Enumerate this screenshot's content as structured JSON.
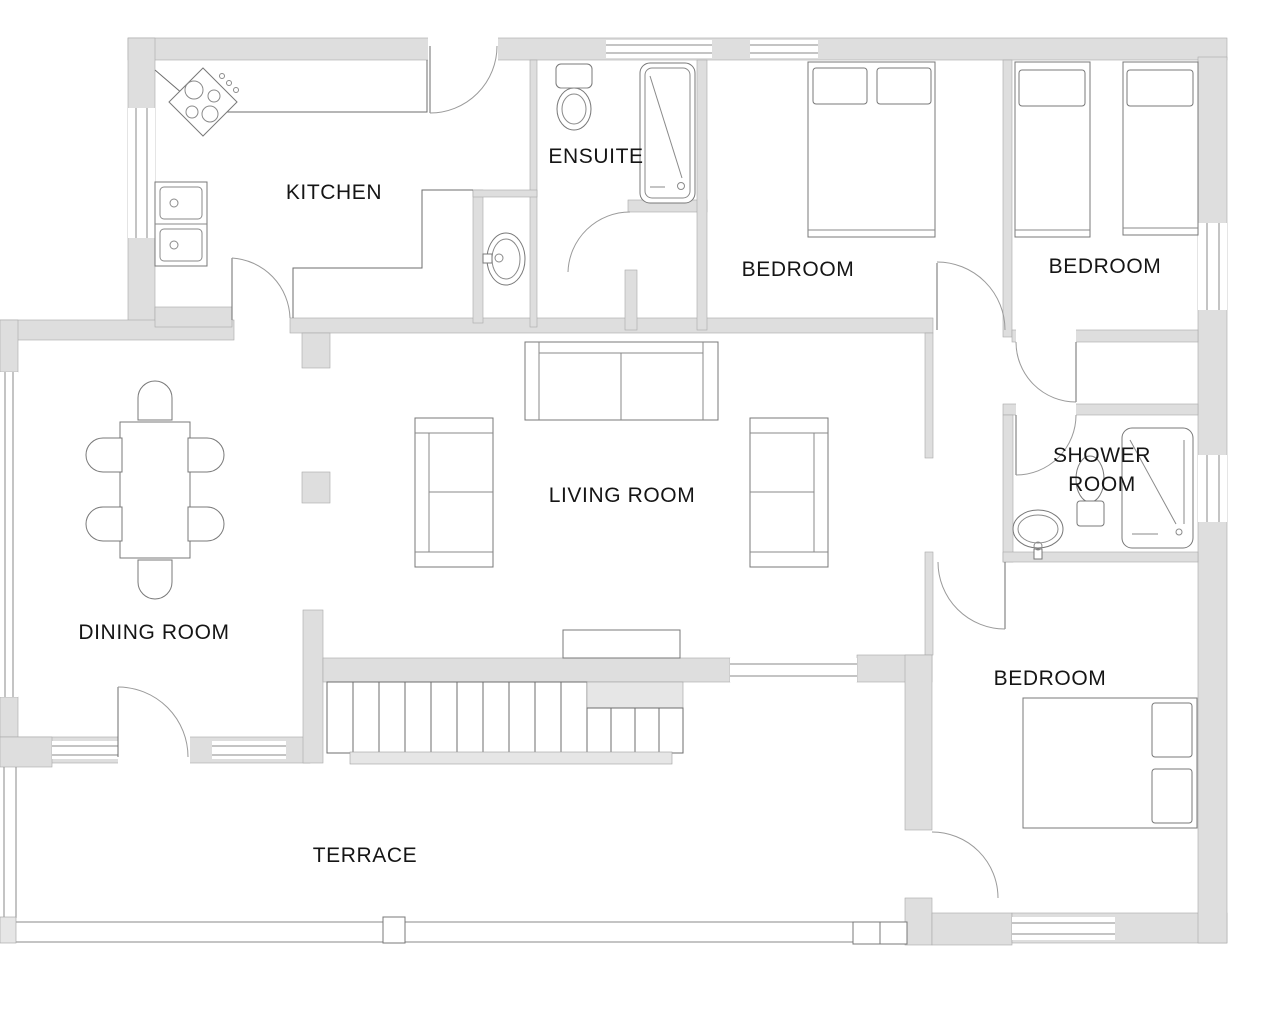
{
  "floor_plan": {
    "rooms": [
      {
        "id": "kitchen",
        "label": "KITCHEN"
      },
      {
        "id": "ensuite",
        "label": "ENSUITE"
      },
      {
        "id": "bedroom-1",
        "label": "BEDROOM"
      },
      {
        "id": "bedroom-2",
        "label": "BEDROOM"
      },
      {
        "id": "shower-room",
        "label": "SHOWER ROOM",
        "lines": [
          "SHOWER",
          "ROOM"
        ]
      },
      {
        "id": "living-room",
        "label": "LIVING ROOM"
      },
      {
        "id": "dining-room",
        "label": "DINING ROOM"
      },
      {
        "id": "bedroom-3",
        "label": "BEDROOM"
      },
      {
        "id": "terrace",
        "label": "TERRACE"
      }
    ],
    "colors": {
      "background": "#ffffff",
      "wall_fill": "#dedede",
      "wall_stroke": "#a8a8a8",
      "line": "#6e6e6e",
      "text": "#151515"
    }
  }
}
